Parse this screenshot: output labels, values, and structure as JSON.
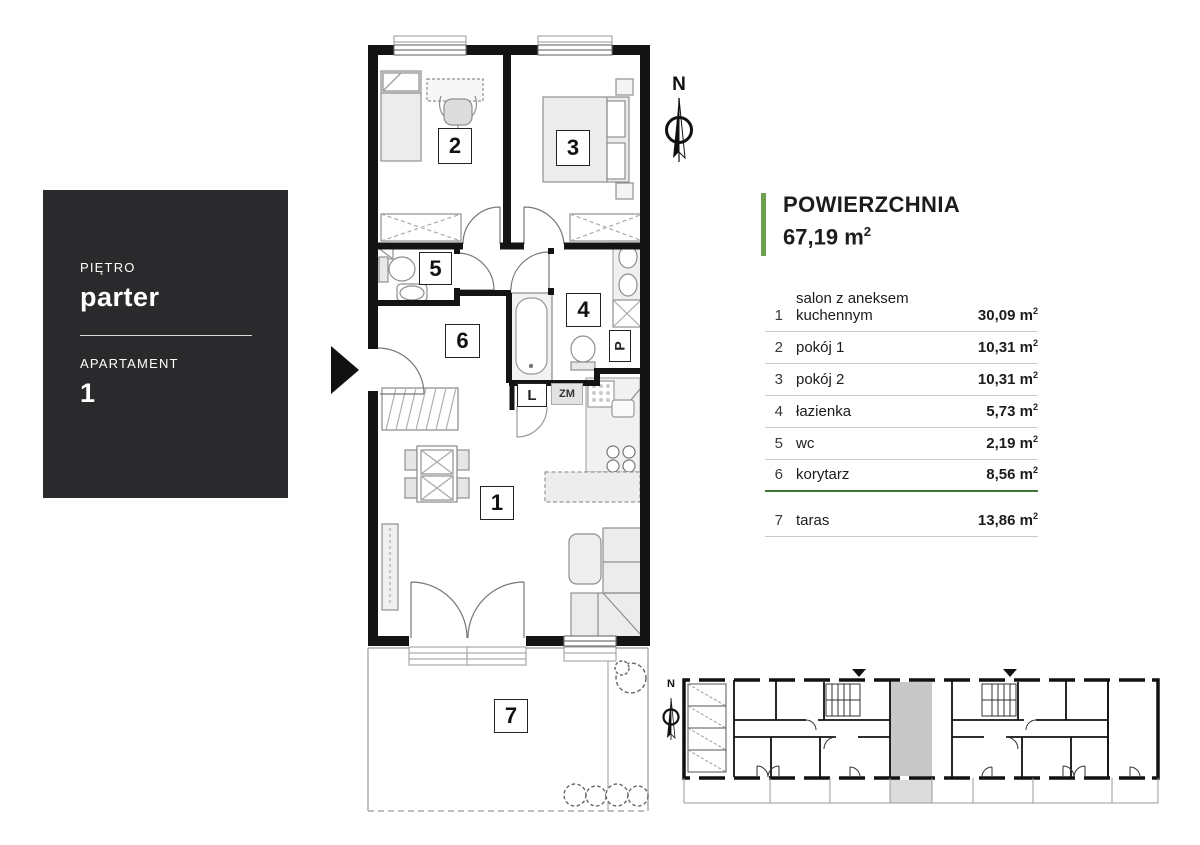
{
  "sidebar": {
    "floor_label": "PIĘTRO",
    "floor_value": "parter",
    "apartment_label": "APARTAMENT",
    "apartment_value": "1"
  },
  "compass": {
    "north": "N"
  },
  "mini_compass": {
    "north": "N"
  },
  "area_panel": {
    "title": "POWIERZCHNIA",
    "total_value": "67,19",
    "unit": "m",
    "unit_sup": "2",
    "rooms": [
      {
        "num": "1",
        "name": "salon z aneksem kuchennym",
        "area": "30,09"
      },
      {
        "num": "2",
        "name": "pokój 1",
        "area": "10,31"
      },
      {
        "num": "3",
        "name": "pokój 2",
        "area": "10,31"
      },
      {
        "num": "4",
        "name": "łazienka",
        "area": "5,73"
      },
      {
        "num": "5",
        "name": "wc",
        "area": "2,19"
      },
      {
        "num": "6",
        "name": "korytarz",
        "area": "8,56"
      },
      {
        "num": "7",
        "name": "taras",
        "area": "13,86"
      }
    ]
  },
  "floor_plan": {
    "appliances": {
      "fridge": "L",
      "dishwasher": "ZM",
      "washer": "P"
    }
  },
  "colors": {
    "accent_green": "#6ca24d",
    "divider_green": "#3f7434",
    "sidebar_dark": "#2a2a2d",
    "wall_black": "#141414",
    "highlight_gray": "#c8c8c8"
  }
}
